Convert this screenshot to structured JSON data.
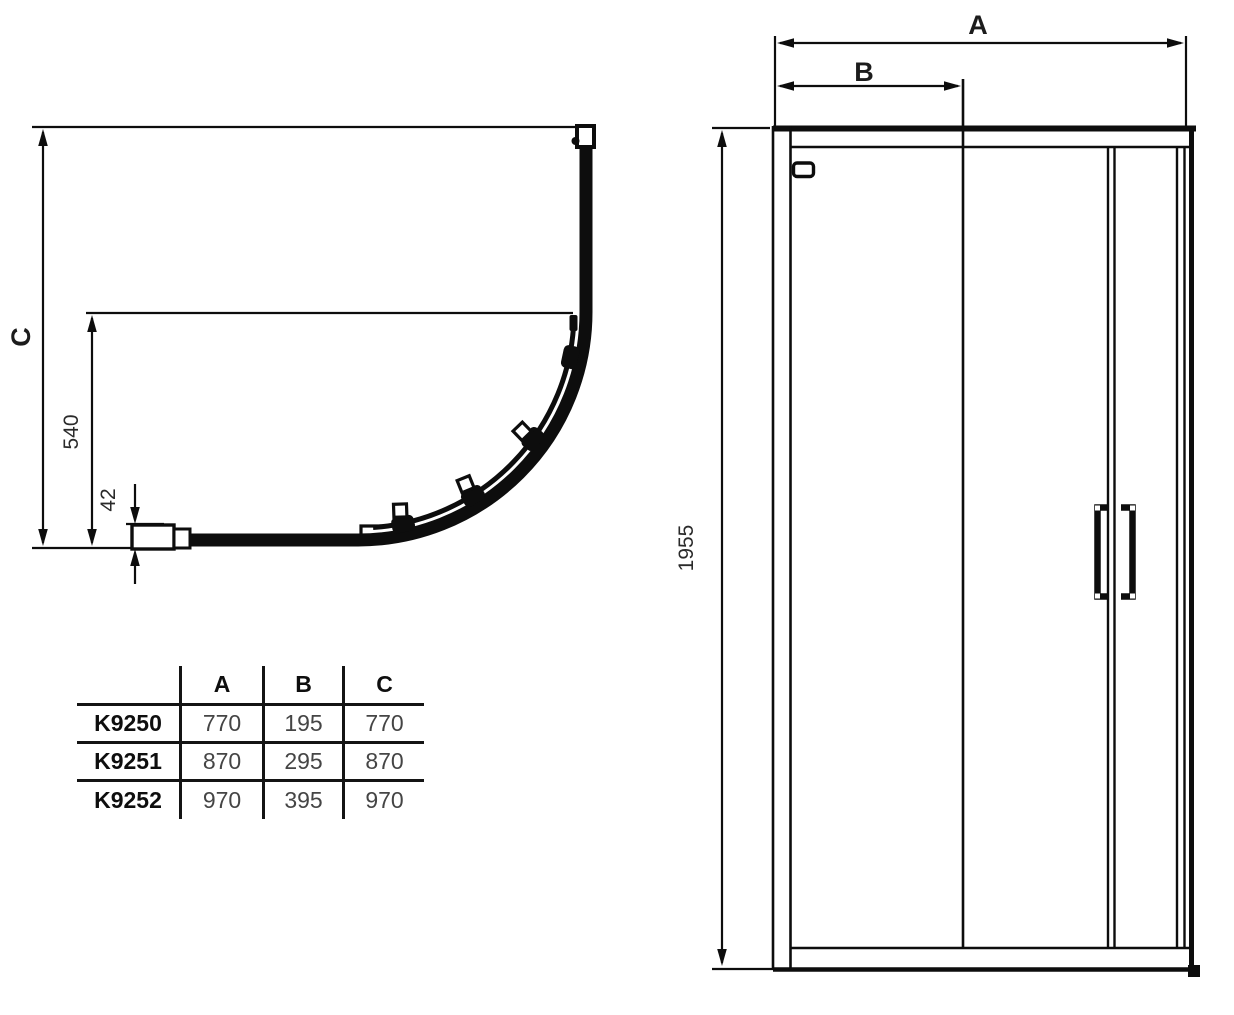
{
  "plan_view": {
    "dim_depth_label": "C",
    "dim_inner_depth": "540",
    "dim_profile_offset": "42"
  },
  "elevation_view": {
    "dim_width_label": "A",
    "dim_door_width_label": "B",
    "dim_height": "1955"
  },
  "spec_table": {
    "headers": {
      "model": "",
      "a": "A",
      "b": "B",
      "c": "C"
    },
    "rows": [
      {
        "model": "K9250",
        "a": "770",
        "b": "195",
        "c": "770"
      },
      {
        "model": "K9251",
        "a": "870",
        "b": "295",
        "c": "870"
      },
      {
        "model": "K9252",
        "a": "970",
        "b": "395",
        "c": "970"
      }
    ]
  },
  "colors": {
    "line": "#0d0d0d",
    "background": "#ffffff",
    "table_value_text": "#454545"
  }
}
